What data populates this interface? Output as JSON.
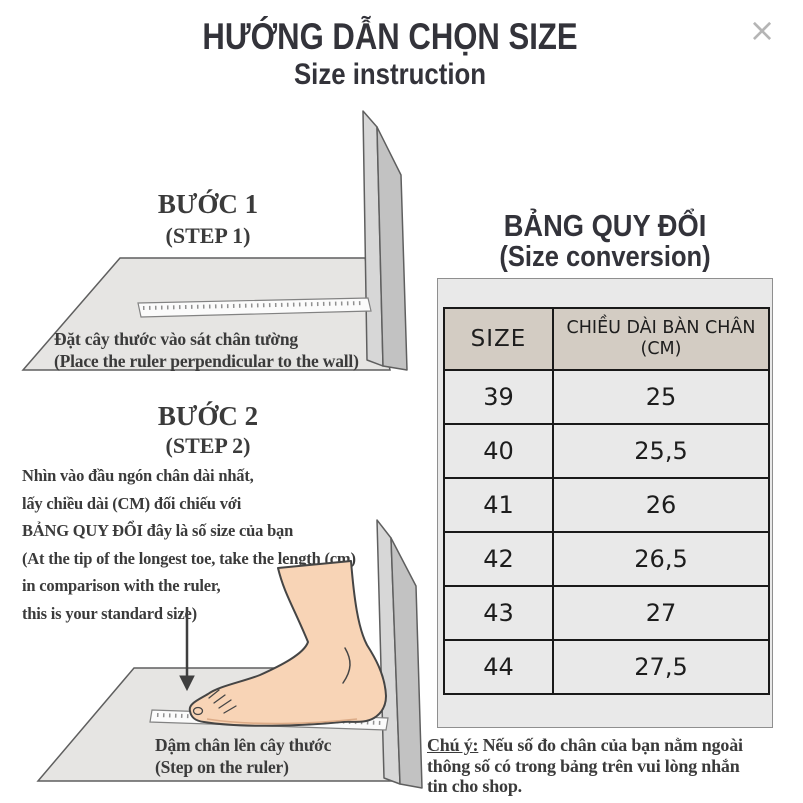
{
  "header": {
    "title": "HƯỚNG DẪN CHỌN SIZE",
    "subtitle": "Size instruction",
    "close_icon": "×"
  },
  "step1": {
    "heading": "BƯỚC 1",
    "subheading": "(STEP 1)",
    "caption_vi": "Đặt cây thước vào sát chân tường",
    "caption_en": "(Place the ruler perpendicular to the wall)"
  },
  "step2": {
    "heading": "BƯỚC 2",
    "subheading": "(STEP 2)",
    "instructions": "Nhìn vào đầu ngón chân dài nhất,\nlấy chiều dài (CM) đối chiếu với\nBẢNG QUY ĐỔI đây là số size của bạn\n(At the tip of the longest toe, take the length (cm)\nin comparison with the ruler,\nthis is your standard size)",
    "caption_vi": "Dậm chân lên cây thước",
    "caption_en": "(Step on the ruler)"
  },
  "conversion": {
    "heading": "BẢNG QUY ĐỔI",
    "subheading": "(Size conversion)",
    "table": {
      "col_size": "SIZE",
      "col_length": "CHIỀU DÀI BÀN CHÂN\n(CM)",
      "rows": [
        {
          "size": "39",
          "cm": "25"
        },
        {
          "size": "40",
          "cm": "25,5"
        },
        {
          "size": "41",
          "cm": "26"
        },
        {
          "size": "42",
          "cm": "26,5"
        },
        {
          "size": "43",
          "cm": "27"
        },
        {
          "size": "44",
          "cm": "27,5"
        }
      ]
    },
    "note_label": "Chú ý:",
    "note_text": " Nếu số đo chân của bạn nằm ngoài\nthông số có trong bảng trên vui lòng nhắn\ntin cho shop."
  },
  "colors": {
    "title_text": "#33333a",
    "body_text": "#3b3b3b",
    "table_header_bg": "#d3ccc3",
    "table_bg": "#e9e9e9",
    "table_border": "#191919",
    "floor_fill": "#e6e5e3",
    "wall_light": "#d7d7d7",
    "wall_dark": "#c2c2c2",
    "skin": "#f8d4b6",
    "close_icon": "#b5b5b5"
  }
}
